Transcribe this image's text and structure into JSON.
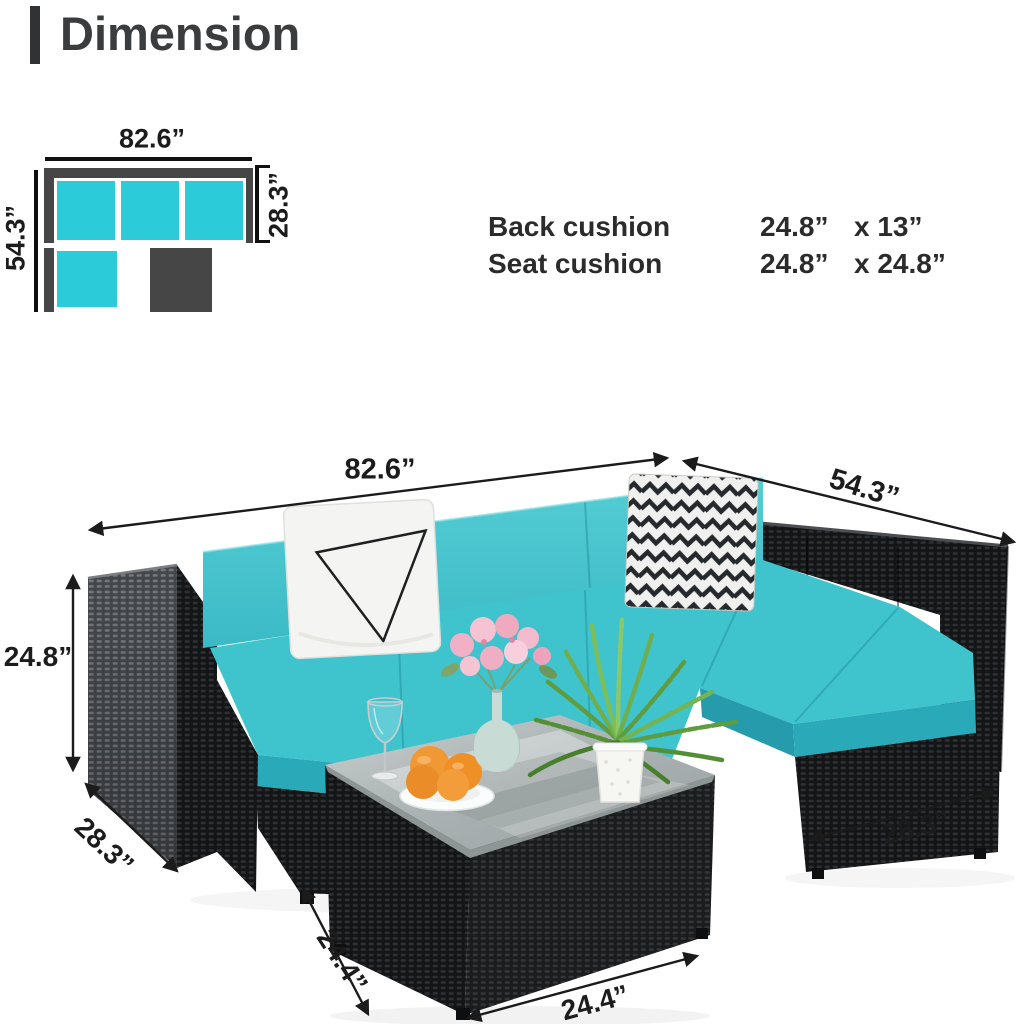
{
  "title": "Dimension",
  "schematic": {
    "width": "82.6”",
    "depth": "54.3”",
    "seat_depth": "28.3”"
  },
  "cushion_specs": {
    "rows": [
      {
        "label": "Back cushion",
        "size": "24.8”",
        "by": "x 13”"
      },
      {
        "label": "Seat cushion",
        "size": "24.8”",
        "by": "x 24.8”"
      }
    ]
  },
  "photo": {
    "labels": {
      "sofa_width": "82.6”",
      "sofa_depth": "54.3”",
      "sofa_height": "24.8”",
      "arm_depth": "28.3”",
      "table_depth": "24.4”",
      "table_width": "24.4”",
      "ottoman_width": "28.3”"
    }
  },
  "colors": {
    "teal_schematic": "#2BCBD9",
    "teal_back_cushion": "#48C7CF",
    "teal_seat_cushion": "#3BBFCA",
    "dark_gray": "#464646",
    "wicker_black": "#17181B",
    "armrest_gray": "#45484C",
    "text": "#1C1C1C",
    "orange": "#F09833",
    "flower_pink": "#F3B9CB",
    "fern_green": "#6FAE4E",
    "vase_celadon": "#C8DBD5"
  }
}
